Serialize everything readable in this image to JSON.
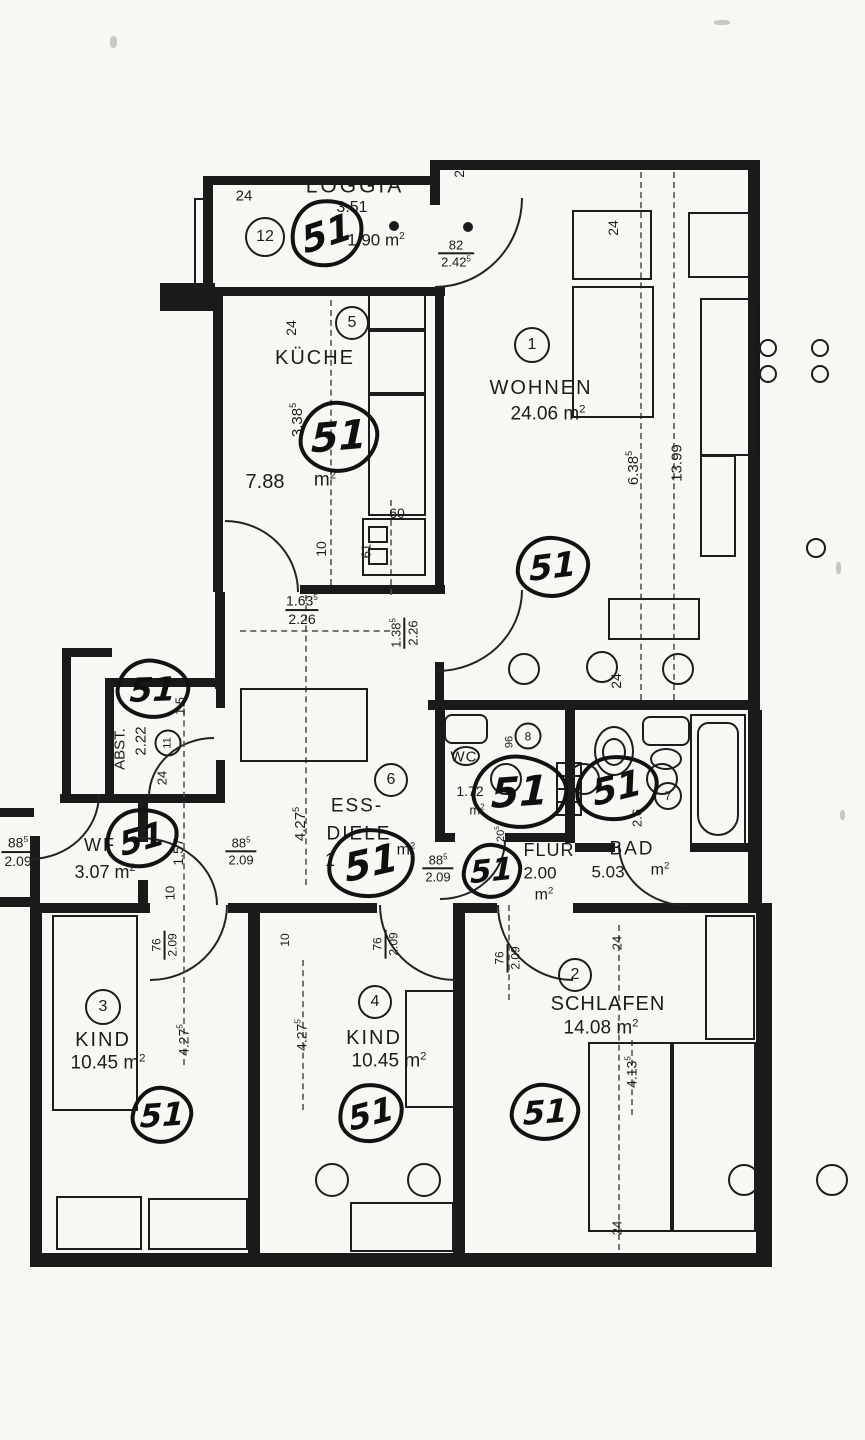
{
  "plan": {
    "language": "de",
    "document_type": "apartment floor plan (photocopy with handwritten marks)",
    "handwritten_mark": "51",
    "ink_color": "#1c1c1c",
    "paper_color": "#f8f7f3",
    "rooms": [
      {
        "number": "1",
        "label": "WOHNEN",
        "area": "24.06 m2"
      },
      {
        "number": "2",
        "label": "SCHLAFEN",
        "area": "14.08 m2"
      },
      {
        "number": "3",
        "label": "KIND",
        "area": "10.45 m2"
      },
      {
        "number": "4",
        "label": "KIND",
        "area": "10.45 m2"
      },
      {
        "number": "5",
        "label": "KÜCHE",
        "area": "7.88 m2"
      },
      {
        "number": "6",
        "label": "ESS-DIELE",
        "area": "1… m2 (partly overwritten)"
      },
      {
        "number": "7",
        "label": "BAD",
        "area": "5.03 m2"
      },
      {
        "number": "8",
        "label": "WC",
        "area": "1.72 m2"
      },
      {
        "number": "11",
        "label": "ABST.",
        "area": "2.22"
      },
      {
        "number": "12",
        "label": "LOGGIA",
        "area": "1.90 m2",
        "note": "3.51"
      },
      {
        "label": "WF",
        "area": "3.07 m2"
      },
      {
        "label": "FLUR",
        "area": "2.00 m2"
      }
    ],
    "annotations": [
      {
        "t": "label",
        "text": "LOGGIA",
        "x": 355,
        "y": 186,
        "fs": 21,
        "ls": 3
      },
      {
        "t": "label",
        "text": "3.51",
        "x": 352,
        "y": 208,
        "fs": 16
      },
      {
        "t": "label",
        "text": "1.90 m",
        "sup": "2",
        "x": 376,
        "y": 240,
        "fs": 17
      },
      {
        "t": "num",
        "text": "12",
        "x": 265,
        "y": 237,
        "d": 40,
        "fs": 16
      },
      {
        "t": "label",
        "text": "24",
        "x": 244,
        "y": 196,
        "fs": 15
      },
      {
        "t": "label",
        "text": "25",
        "x": 459,
        "y": 170,
        "fs": 14,
        "rot": -90
      },
      {
        "t": "frac",
        "top": "82",
        "bottom": "2.42",
        "bsup": "5",
        "x": 456,
        "y": 254,
        "fs": 13
      },
      {
        "t": "label",
        "text": "KÜCHE",
        "x": 315,
        "y": 358,
        "fs": 20,
        "ls": 2
      },
      {
        "t": "num",
        "text": "5",
        "x": 352,
        "y": 323,
        "d": 34,
        "fs": 16
      },
      {
        "t": "label",
        "text": "24",
        "x": 291,
        "y": 328,
        "fs": 14,
        "rot": -90
      },
      {
        "t": "label",
        "text": "3.38",
        "sup": "5",
        "x": 297,
        "y": 420,
        "fs": 15,
        "rot": -90
      },
      {
        "t": "label",
        "text": "7.88",
        "x": 265,
        "y": 482,
        "fs": 20
      },
      {
        "t": "label",
        "text": "m",
        "sup": "2",
        "x": 325,
        "y": 480,
        "fs": 19
      },
      {
        "t": "label",
        "text": "60",
        "x": 397,
        "y": 513,
        "fs": 14
      },
      {
        "t": "label",
        "text": "61",
        "x": 366,
        "y": 551,
        "fs": 13,
        "rot": -90
      },
      {
        "t": "label",
        "text": "10",
        "x": 321,
        "y": 549,
        "fs": 14,
        "rot": -90
      },
      {
        "t": "frac",
        "top": "1.63",
        "tsup": "5",
        "bottom": "2.26",
        "x": 302,
        "y": 610,
        "fs": 14
      },
      {
        "t": "frac",
        "top": "1.38",
        "tsup": "5",
        "bottom": "2.26",
        "x": 405,
        "y": 633,
        "fs": 13,
        "rot": -90
      },
      {
        "t": "label",
        "text": "WOHNEN",
        "x": 541,
        "y": 388,
        "fs": 20,
        "ls": 2
      },
      {
        "t": "label",
        "text": "24.06 m",
        "sup": "2",
        "x": 548,
        "y": 414,
        "fs": 19
      },
      {
        "t": "num",
        "text": "1",
        "x": 532,
        "y": 345,
        "d": 36,
        "fs": 16
      },
      {
        "t": "label",
        "text": "6.38",
        "sup": "5",
        "x": 633,
        "y": 468,
        "fs": 15,
        "rot": -90
      },
      {
        "t": "label",
        "text": "13.99",
        "x": 677,
        "y": 463,
        "fs": 15,
        "rot": -90
      },
      {
        "t": "label",
        "text": "24",
        "x": 613,
        "y": 228,
        "fs": 14,
        "rot": -90
      },
      {
        "t": "label",
        "text": "24",
        "x": 616,
        "y": 681,
        "fs": 14,
        "rot": -90
      },
      {
        "t": "label",
        "text": "ABST.",
        "x": 120,
        "y": 749,
        "fs": 15,
        "rot": -90
      },
      {
        "t": "label",
        "text": "2.22",
        "x": 141,
        "y": 741,
        "fs": 15,
        "rot": -90
      },
      {
        "t": "num",
        "text": "11",
        "x": 168,
        "y": 743,
        "d": 27,
        "fs": 11,
        "rot": -90
      },
      {
        "t": "label",
        "text": "24",
        "x": 162,
        "y": 778,
        "fs": 13,
        "rot": -90
      },
      {
        "t": "label",
        "text": "1.5",
        "x": 180,
        "y": 706,
        "fs": 13,
        "rot": -90
      },
      {
        "t": "label",
        "text": "1.57",
        "x": 178,
        "y": 852,
        "fs": 14,
        "rot": -90
      },
      {
        "t": "label",
        "text": "10",
        "x": 170,
        "y": 893,
        "fs": 13,
        "rot": -90
      },
      {
        "t": "label",
        "text": "WF",
        "x": 100,
        "y": 845,
        "fs": 18,
        "ls": 2
      },
      {
        "t": "label",
        "text": "3.07 m",
        "sup": "2",
        "x": 105,
        "y": 872,
        "fs": 18
      },
      {
        "t": "frac",
        "top": "88",
        "tsup": "5",
        "bottom": "2.09",
        "x": 18,
        "y": 852,
        "fs": 14
      },
      {
        "t": "frac",
        "top": "88",
        "tsup": "5",
        "bottom": "2.09",
        "x": 241,
        "y": 852,
        "fs": 13
      },
      {
        "t": "frac",
        "top": "88",
        "tsup": "5",
        "bottom": "2.09",
        "x": 438,
        "y": 869,
        "fs": 13
      },
      {
        "t": "label",
        "text": "ESS-",
        "x": 357,
        "y": 806,
        "fs": 19,
        "ls": 2
      },
      {
        "t": "label",
        "text": "DIELE",
        "x": 359,
        "y": 834,
        "fs": 19,
        "ls": 2
      },
      {
        "t": "num",
        "text": "6",
        "x": 391,
        "y": 780,
        "d": 34,
        "fs": 16
      },
      {
        "t": "label",
        "text": "1",
        "x": 330,
        "y": 860,
        "fs": 18
      },
      {
        "t": "label",
        "text": "m",
        "sup": "2",
        "x": 406,
        "y": 850,
        "fs": 16
      },
      {
        "t": "label",
        "text": "4.27",
        "sup": "5",
        "x": 300,
        "y": 824,
        "fs": 15,
        "rot": -90
      },
      {
        "t": "label",
        "text": "WC",
        "x": 464,
        "y": 757,
        "fs": 15,
        "ls": 1
      },
      {
        "t": "label",
        "text": "1.72",
        "x": 470,
        "y": 791,
        "fs": 14
      },
      {
        "t": "label",
        "text": "m",
        "sup": "2",
        "x": 477,
        "y": 810,
        "fs": 13
      },
      {
        "t": "num",
        "text": "8",
        "x": 528,
        "y": 736,
        "d": 27,
        "fs": 12
      },
      {
        "t": "label",
        "text": "96",
        "x": 510,
        "y": 742,
        "fs": 11,
        "rot": -90
      },
      {
        "t": "label",
        "text": "20",
        "sup": "5",
        "x": 501,
        "y": 834,
        "fs": 11,
        "rot": -90
      },
      {
        "t": "label",
        "text": "FLUR",
        "x": 549,
        "y": 850,
        "fs": 18,
        "ls": 1
      },
      {
        "t": "label",
        "text": "2.00",
        "x": 540,
        "y": 873,
        "fs": 17
      },
      {
        "t": "label",
        "text": "m",
        "sup": "2",
        "x": 544,
        "y": 895,
        "fs": 16
      },
      {
        "t": "label",
        "text": "BAD",
        "x": 632,
        "y": 849,
        "fs": 19,
        "ls": 2
      },
      {
        "t": "label",
        "text": "5.03",
        "x": 608,
        "y": 872,
        "fs": 17
      },
      {
        "t": "label",
        "text": "m",
        "sup": "2",
        "x": 660,
        "y": 870,
        "fs": 16
      },
      {
        "t": "num",
        "text": "7",
        "x": 668,
        "y": 796,
        "d": 28,
        "fs": 12
      },
      {
        "t": "label",
        "text": "2.6",
        "x": 637,
        "y": 818,
        "fs": 13,
        "rot": -90
      },
      {
        "t": "frac",
        "top": "76",
        "bottom": "2.09",
        "x": 165,
        "y": 945,
        "fs": 12,
        "rot": -90
      },
      {
        "t": "frac",
        "top": "76",
        "bottom": "2.09",
        "x": 386,
        "y": 944,
        "fs": 12,
        "rot": -90
      },
      {
        "t": "frac",
        "top": "76",
        "bottom": "2.09",
        "x": 508,
        "y": 958,
        "fs": 12,
        "rot": -90
      },
      {
        "t": "label",
        "text": "10",
        "x": 285,
        "y": 940,
        "fs": 12,
        "rot": -90
      },
      {
        "t": "num",
        "text": "3",
        "x": 103,
        "y": 1007,
        "d": 36,
        "fs": 16
      },
      {
        "t": "label",
        "text": "KIND",
        "x": 103,
        "y": 1040,
        "fs": 20,
        "ls": 2
      },
      {
        "t": "label",
        "text": "10.45 m",
        "sup": "2",
        "x": 108,
        "y": 1063,
        "fs": 19
      },
      {
        "t": "label",
        "text": "4.27",
        "sup": "5",
        "x": 183,
        "y": 1040,
        "fs": 14,
        "rot": -90
      },
      {
        "t": "num",
        "text": "4",
        "x": 375,
        "y": 1002,
        "d": 34,
        "fs": 16
      },
      {
        "t": "label",
        "text": "KIND",
        "x": 374,
        "y": 1038,
        "fs": 20,
        "ls": 2
      },
      {
        "t": "label",
        "text": "10.45 m",
        "sup": "2",
        "x": 389,
        "y": 1061,
        "fs": 19
      },
      {
        "t": "label",
        "text": "4.27",
        "sup": "5",
        "x": 301,
        "y": 1035,
        "fs": 14,
        "rot": -90
      },
      {
        "t": "num",
        "text": "2",
        "x": 575,
        "y": 975,
        "d": 34,
        "fs": 16
      },
      {
        "t": "label",
        "text": "SCHLAFEN",
        "x": 608,
        "y": 1004,
        "fs": 20,
        "ls": 1
      },
      {
        "t": "label",
        "text": "14.08 m",
        "sup": "2",
        "x": 601,
        "y": 1028,
        "fs": 19
      },
      {
        "t": "label",
        "text": "24",
        "x": 617,
        "y": 943,
        "fs": 13,
        "rot": -90
      },
      {
        "t": "label",
        "text": "4.13",
        "sup": "5",
        "x": 631,
        "y": 1072,
        "fs": 14,
        "rot": -90
      },
      {
        "t": "label",
        "text": "24",
        "x": 617,
        "y": 1228,
        "fs": 13,
        "rot": -90
      }
    ],
    "scribbles": [
      {
        "text": "51",
        "x": 327,
        "y": 233,
        "w": 74,
        "h": 68,
        "rot": -8
      },
      {
        "text": "51",
        "x": 339,
        "y": 437,
        "w": 80,
        "h": 72,
        "rot": 5
      },
      {
        "text": "51",
        "x": 553,
        "y": 567,
        "w": 74,
        "h": 62,
        "rot": 3
      },
      {
        "text": "51",
        "x": 153,
        "y": 689,
        "w": 74,
        "h": 60,
        "rot": 8
      },
      {
        "text": "51",
        "x": 142,
        "y": 838,
        "w": 74,
        "h": 60,
        "rot": -6
      },
      {
        "text": "51",
        "x": 371,
        "y": 863,
        "w": 88,
        "h": 70,
        "rot": -3
      },
      {
        "text": "51",
        "x": 520,
        "y": 792,
        "w": 96,
        "h": 74,
        "rot": 6
      },
      {
        "text": "51",
        "x": 492,
        "y": 871,
        "w": 60,
        "h": 56,
        "rot": 4
      },
      {
        "text": "51",
        "x": 617,
        "y": 788,
        "w": 84,
        "h": 66,
        "rot": -4
      },
      {
        "text": "51",
        "x": 162,
        "y": 1115,
        "w": 62,
        "h": 58,
        "rot": 6
      },
      {
        "text": "51",
        "x": 371,
        "y": 1113,
        "w": 66,
        "h": 60,
        "rot": -5
      },
      {
        "text": "51",
        "x": 545,
        "y": 1112,
        "w": 70,
        "h": 58,
        "rot": 5
      }
    ]
  }
}
